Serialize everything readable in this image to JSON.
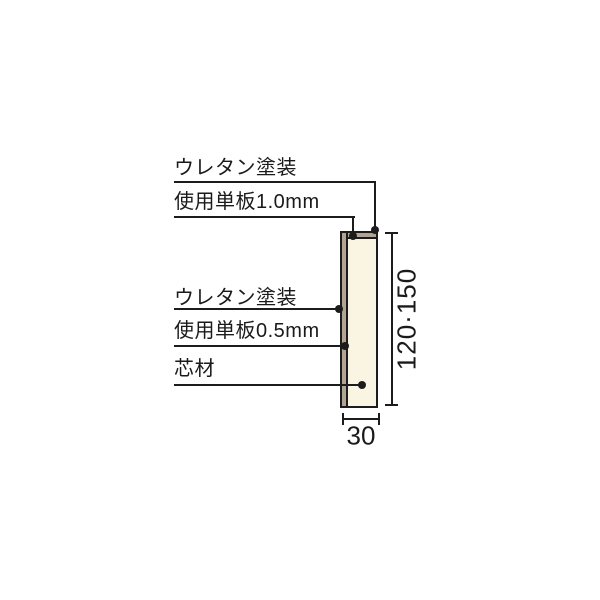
{
  "diagram": {
    "description": "panel-cross-section-diagram",
    "callouts": [
      {
        "id": "coating-top",
        "text": "ウレタン塗装"
      },
      {
        "id": "veneer-top",
        "text": "使用単板1.0mm"
      },
      {
        "id": "coating-side",
        "text": "ウレタン塗装"
      },
      {
        "id": "veneer-side",
        "text": "使用単板0.5mm"
      },
      {
        "id": "core",
        "text": "芯材"
      }
    ],
    "dimensions": {
      "height": "120·150",
      "width": "30"
    },
    "colors": {
      "background": "#ffffff",
      "line": "#1c1c1c",
      "text": "#1a1a1a",
      "core_fill": "#faf5e3",
      "veneer_fill": "#b1a492"
    }
  }
}
